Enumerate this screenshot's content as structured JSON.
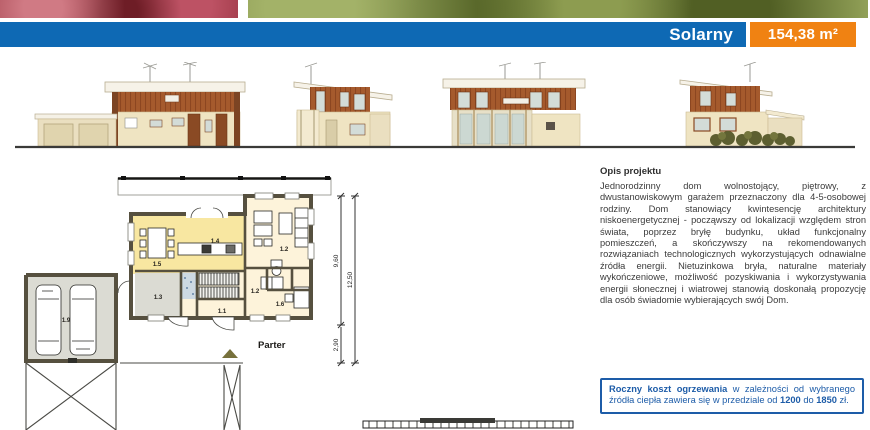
{
  "header": {
    "title": "Solarny",
    "area": "154,38 m²"
  },
  "plan": {
    "floor_label": "Parter",
    "rooms": {
      "hall": "1.1",
      "room_top_right": "1.2",
      "corridor": "1.2",
      "utility": "1.3",
      "kitchen_living": "1.4",
      "dining": "1.5",
      "room_bottom_right": "1.6",
      "garage": "1.9"
    },
    "dimensions": {
      "depth_main": "9,60",
      "depth_porch": "2,90",
      "depth_total": "12,50"
    }
  },
  "description": {
    "heading": "Opis projektu",
    "body": "Jednorodzinny dom wolnostojący, piętrowy, z dwustanowiskowym garażem przeznaczony dla 4-5-osobowej rodziny. Dom stanowiący kwintesencję architektury niskoenergetycznej - począwszy od lokalizacji względem stron świata, poprzez bryłę budynku, układ funkcjonalny pomieszczeń, a skończywszy na rekomendowanych rozwiązaniach technologicznych wykorzystujących odnawialne źródła energii. Nietuzinkowa bryła, naturalne materiały wykończeniowe, możliwość pozyskiwania i wykorzystywania energii słonecznej i wiatrowej stanowią doskonałą propozycję dla osób świadomie wybierających swój Dom."
  },
  "heating_box": {
    "bold_lead": "Roczny koszt ogrzewania",
    "text_1": " w zależności od wybranego źródła ciepła zawiera się w przedziale od ",
    "value_1": "1200",
    "text_2": " do ",
    "value_2": "1850",
    "text_3": " zł."
  },
  "colors": {
    "accent_blue": "#0e69b4",
    "accent_orange": "#f08212",
    "text_blue": "#1d5ca8"
  }
}
